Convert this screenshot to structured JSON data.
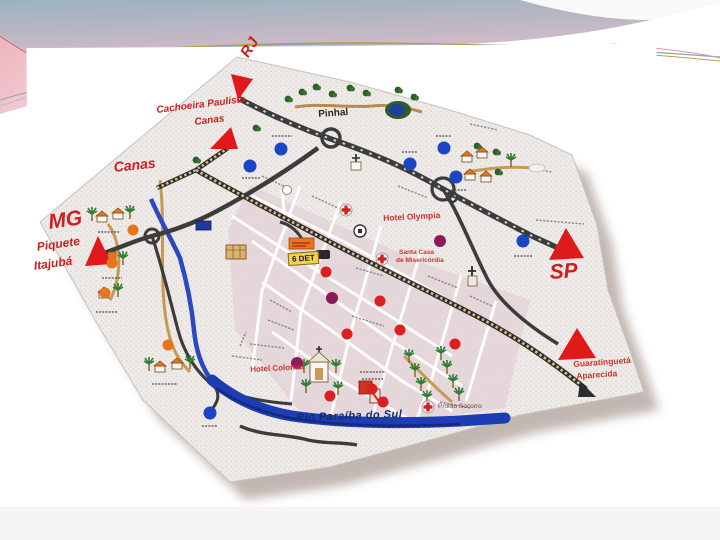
{
  "slide": {
    "type": "presentation-slide-with-scanned-city-map",
    "background_color": "#ffffff"
  },
  "header_decoration": {
    "gradient_top": "#9bb1bf",
    "gradient_bottom": "#f0c3ca",
    "wave_color": "#ffffff",
    "accent_line_blue": "#8aa3b5",
    "accent_line_olive": "#b0a23f",
    "left_wedge_pink": "#e9aebc"
  },
  "map": {
    "region_markers": {
      "rj": "RJ",
      "mg": "MG",
      "sp": "SP"
    },
    "destinations": {
      "cachoeira_line1": "Cachoeira Paulista",
      "cachoeira_line2": "Canas",
      "canas": "Canas",
      "piquete": "Piquete",
      "itajuba": "Itajubá",
      "guaratingueta": "Guaratinguetá",
      "aparecida": "Aparecida"
    },
    "places": {
      "pinhal": "Pinhal",
      "hotel_olympia": "Hotel Olympia",
      "santa_casa_line1": "Santa Casa",
      "santa_casa_line2": "de Misericórdia",
      "det": "6 DET",
      "hotel_colonial": "Hotel Colonial",
      "pronto_socorro": "Pronto Socorro"
    },
    "river_label": "Rio Paraíba do Sul",
    "marker_colors": {
      "triangle_red": "#e01a1a",
      "dot_blue": "#1c45c4",
      "dot_red": "#da2020",
      "dot_purple": "#8d1a58",
      "dot_orange": "#e8741c",
      "hospital_cross_red": "#d41f1f"
    },
    "feature_colors": {
      "paper": "#edeae8",
      "paper_dots": "#d9c5c6",
      "city_blocks": "#e3d4d7",
      "street": "#ffffff",
      "road_dark": "#3c3c3c",
      "railway_tie": "#d9c188",
      "river_blue": "#1d3db5",
      "tan_road": "#c59a55",
      "tree_green": "#2e5d28",
      "shadow_brown": "#7a6054"
    },
    "icons": [
      "triangle-marker-icon",
      "roundabout-icon",
      "railway-icon",
      "church-icon",
      "palm-tree-icon",
      "tree-icon",
      "house-icon",
      "hospital-cross-icon",
      "pond-icon",
      "bus-icon",
      "locomotive-icon",
      "bridge-arc-icon",
      "phone-icon"
    ]
  }
}
